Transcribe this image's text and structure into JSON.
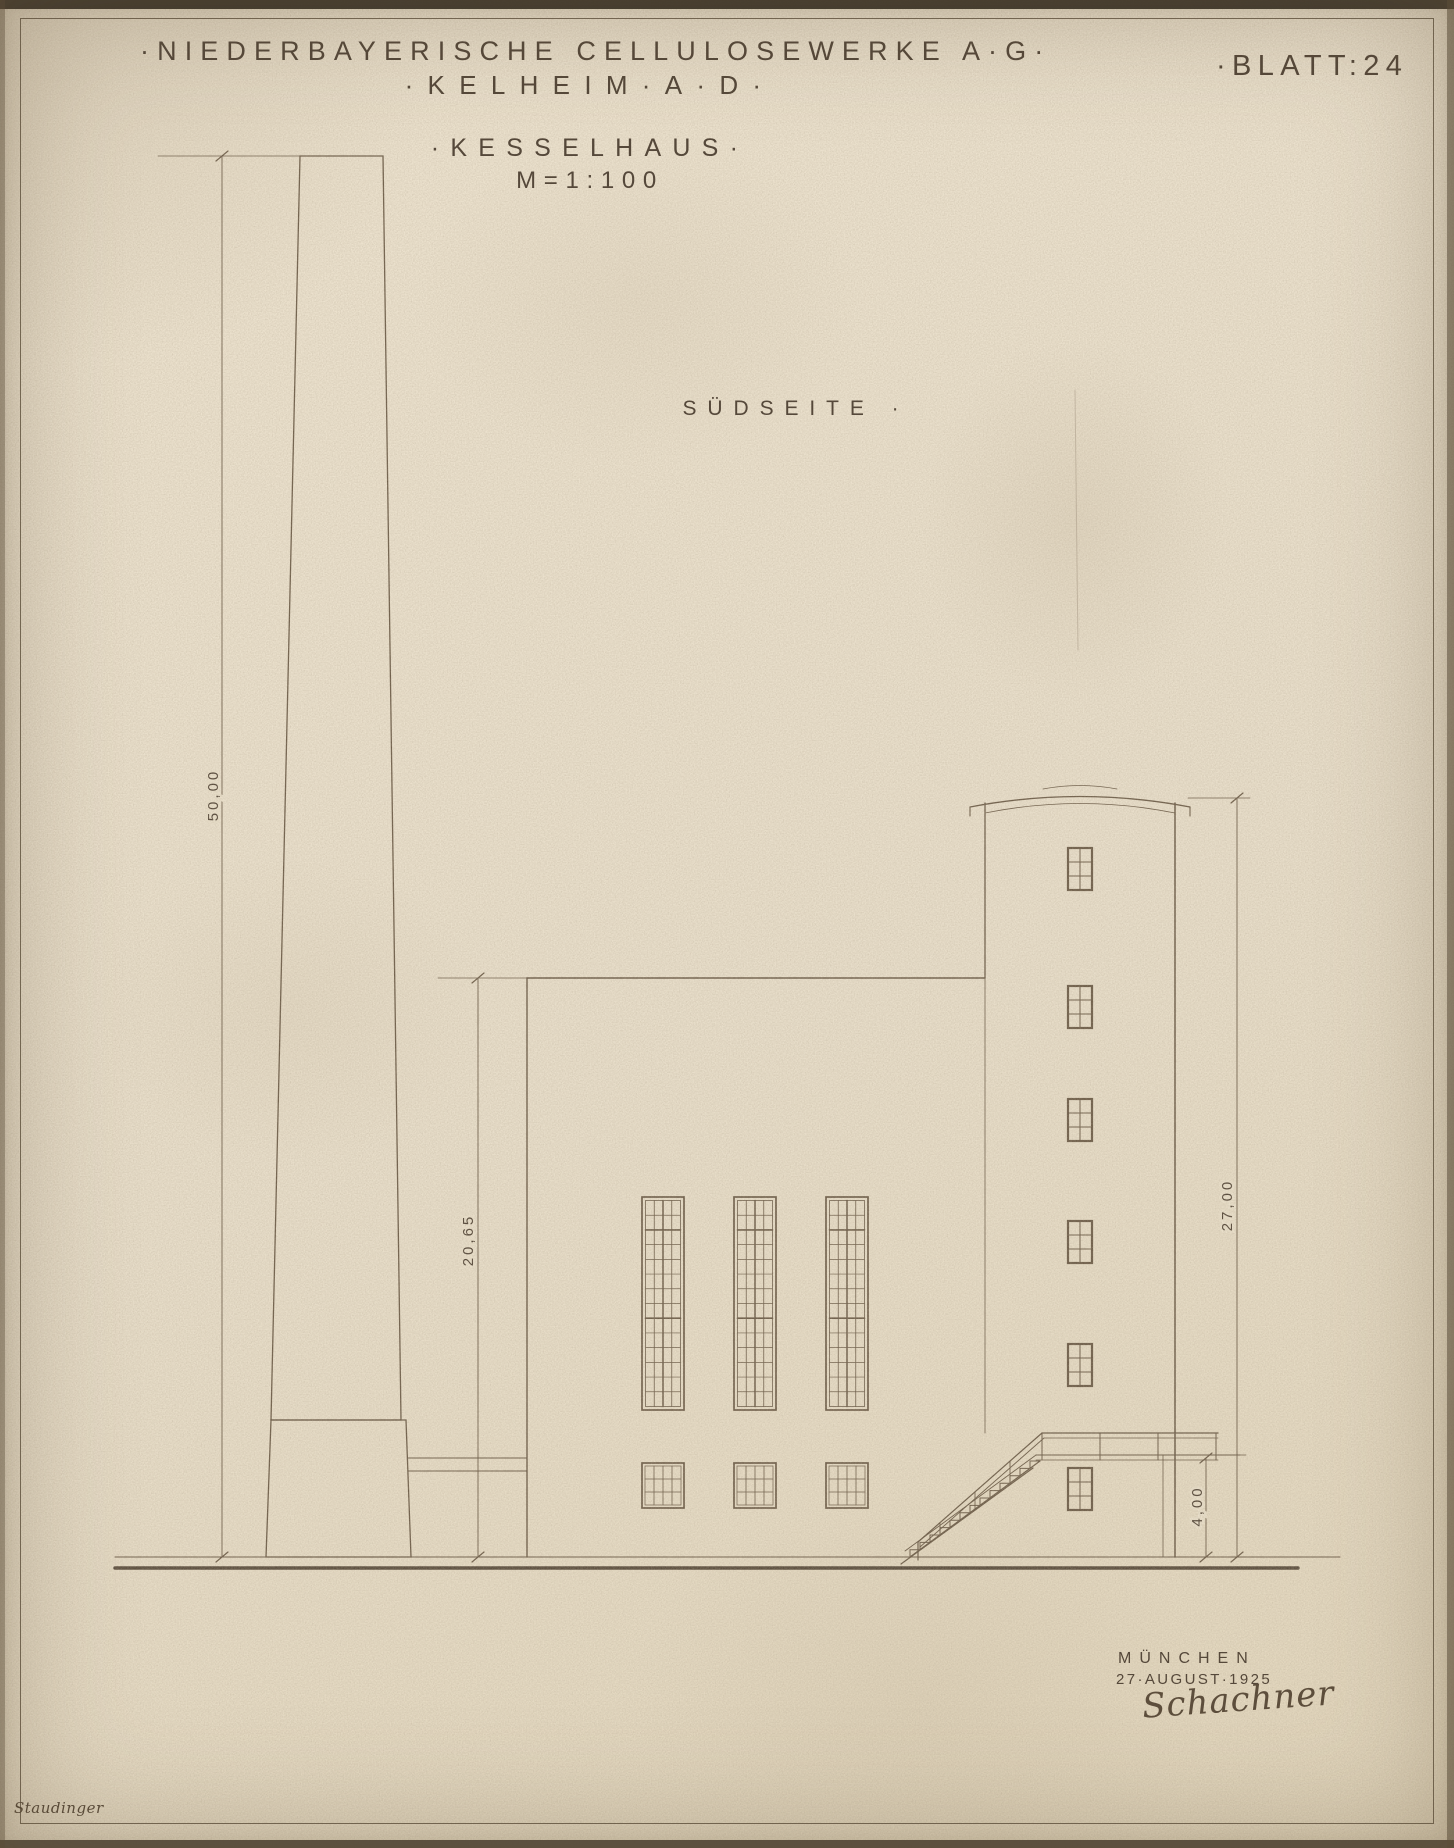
{
  "header": {
    "company": "·NIEDERBAYERISCHE CELLULOSEWERKE A·G·",
    "location": "·KELHEIM·A·D·",
    "sheet_number": "·BLATT:24"
  },
  "title": {
    "name": "·KESSELHAUS·",
    "scale": "M=1:100"
  },
  "view": {
    "label": "SÜDSEITE ·"
  },
  "drawing": {
    "dimensions": {
      "chimney": "50,00",
      "hall": "20,65",
      "tower": "27,00",
      "platform": "4,00"
    }
  },
  "footer": {
    "place": "MÜNCHEN",
    "date": "27·AUGUST·1925",
    "signature": "Schachner",
    "margin_note": "Staudinger"
  },
  "colors": {
    "paper": "#e9dfca",
    "ink": "#6f5f4b",
    "text": "#55483a",
    "border": "#3b332a"
  }
}
